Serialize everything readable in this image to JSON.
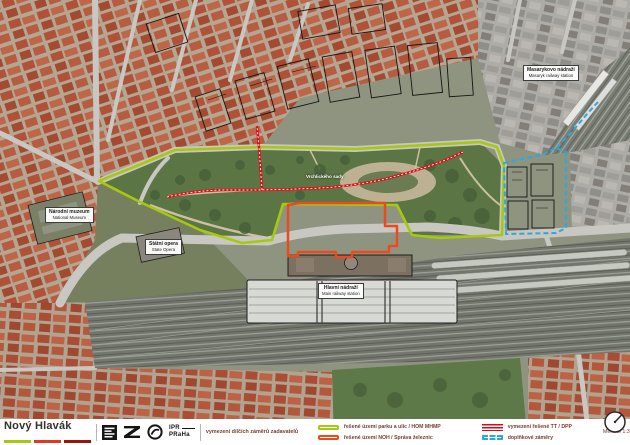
{
  "document": {
    "title": "Nový Hlavák",
    "subtitle": "vymezení dílčích záměrů zadavatelů",
    "scale_note": "Měřítko 1:3 000 / A3 (420x297 mm)"
  },
  "colors": {
    "park_streets": "#a6c80e",
    "noh": "#ea4a1d",
    "tram": "#e30613",
    "supplementary": "#2aa9e0",
    "title_bar_green": "#a6c80e",
    "title_bar_red": "#e23a1e",
    "title_bar_darkred": "#9c1407",
    "footer_text": "#7b3b2f"
  },
  "logos": {
    "praha": "praha-block-logo",
    "sprava_zeleznic": "sprava-zeleznic-logo",
    "dpp": "dpp-logo",
    "ipr_top": "IPR",
    "ipr_bottom": "PRaHa"
  },
  "legend": [
    {
      "label": "řešené území parku a ulic / HOM MHMP",
      "swatch": "green-outline"
    },
    {
      "label": "řešené území NOH / Správa železnic",
      "swatch": "red-outline"
    },
    {
      "label": "vymezení řešené TT / DPP",
      "swatch": "red-stripes"
    },
    {
      "label": "doplňkové záměry",
      "swatch": "blue-dashed"
    }
  ],
  "map_labels": {
    "narodni_muzeum": {
      "cz": "Národní muzeum",
      "en": "National Museum"
    },
    "statni_opera": {
      "cz": "Státní opera",
      "en": "State Opera"
    },
    "vrchlickeho_sady": {
      "cz": "Vrchlického sady"
    },
    "hlavni_nadrazi": {
      "cz": "Hlavní nádraží",
      "en": "Main railway station"
    },
    "masarykovo_nadrazi": {
      "cz": "Masarykovo nádraží",
      "en": "Masaryk railway station"
    }
  }
}
